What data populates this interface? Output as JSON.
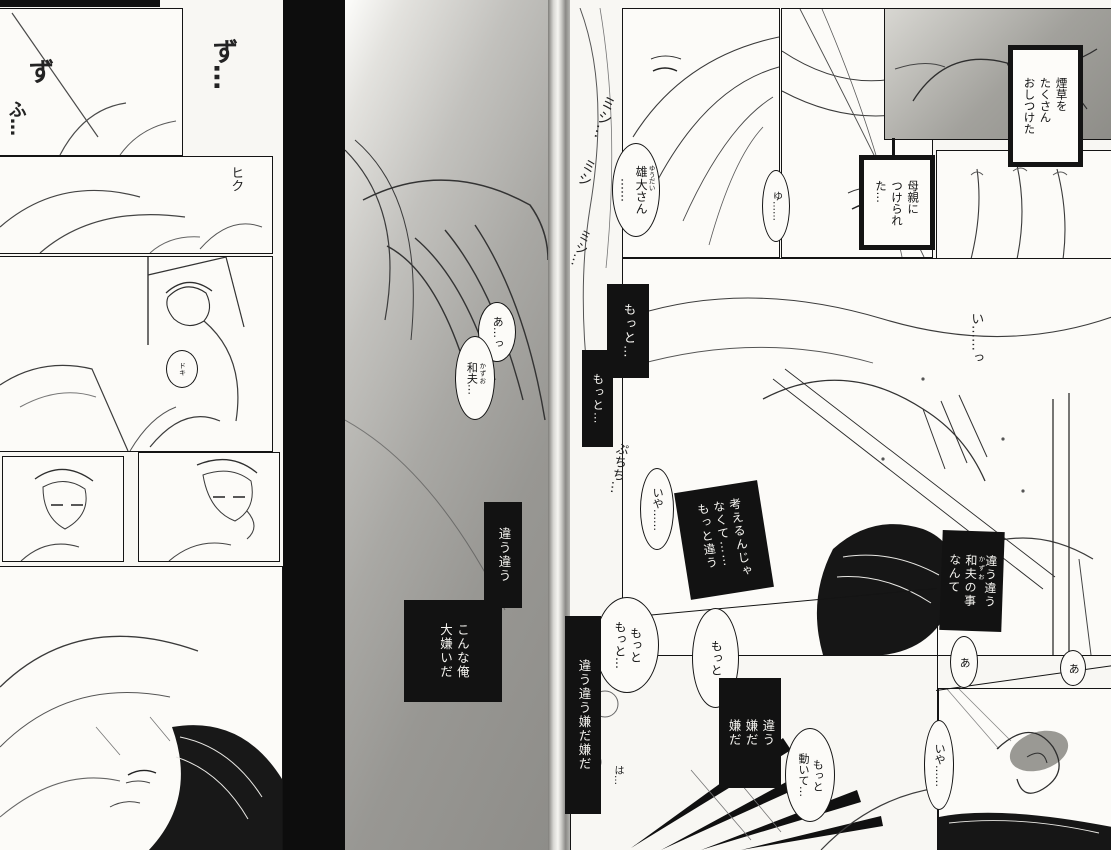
{
  "meta": {
    "kind": "manga two-page spread, black-and-white scan"
  },
  "colors": {
    "ink": "#141414",
    "paper": "#f8f7f3",
    "tone_gray": "#a8a7a3",
    "gutter_black": "#0d0d0d"
  },
  "left_page": {
    "sfx_zu_right": "ず…",
    "sfx_zu_left": "ず",
    "sfx_fu": "ふ…",
    "sfx_hiku": "ヒク",
    "sfx_doki": "ドキ",
    "bubble_a": "あ…っ",
    "bubble_kazuo": {
      "base": "和夫",
      "furi": "かずお",
      "rest": "…"
    },
    "box_chigau": "違う違う",
    "box_konna": "こんな俺\n大嫌いだ"
  },
  "right_page": {
    "sfx_mishi": [
      "ミシ…",
      "ミシ",
      "ミッ",
      "ミシ…"
    ],
    "bubble_yudai": {
      "base": "雄大",
      "furi": "ゆうだい",
      "rest": "さん",
      "col2": "……"
    },
    "bubble_yu": "ゆ……",
    "box_tabako": "煙草を\nたくさん\nおしつけた",
    "box_hahaoya": "母親に\nつけられ\nた…",
    "sfx_i": "い……っ",
    "box_motto_1": "もっと…",
    "box_motto_2": "もっと…",
    "sfx_puchi": "ぷちち…",
    "bubble_iya_1": "いや……",
    "box_kangaeru": "考えるんじゃ\nなくて……\nもっと違う",
    "box_chigau_kazuo": {
      "col1": "違う違う",
      "col2_base": "和夫",
      "col2_furi": "かずお",
      "col2_rest": "の事",
      "col3": "なんて"
    },
    "bubble_a_1": "あ",
    "bubble_a_2": "あ",
    "bubble_motto_3": "もっと\nもっと…",
    "bubble_motto_4": "もっと",
    "box_iyada_tall": "違う違う嫌だ嫌だ",
    "box_iyada_2": "違う\n嫌だ\n嫌だ",
    "bubble_ugoite": "もっと\n動いて…",
    "sfx_ha": "は…",
    "bubble_iya_2": "いや……"
  }
}
